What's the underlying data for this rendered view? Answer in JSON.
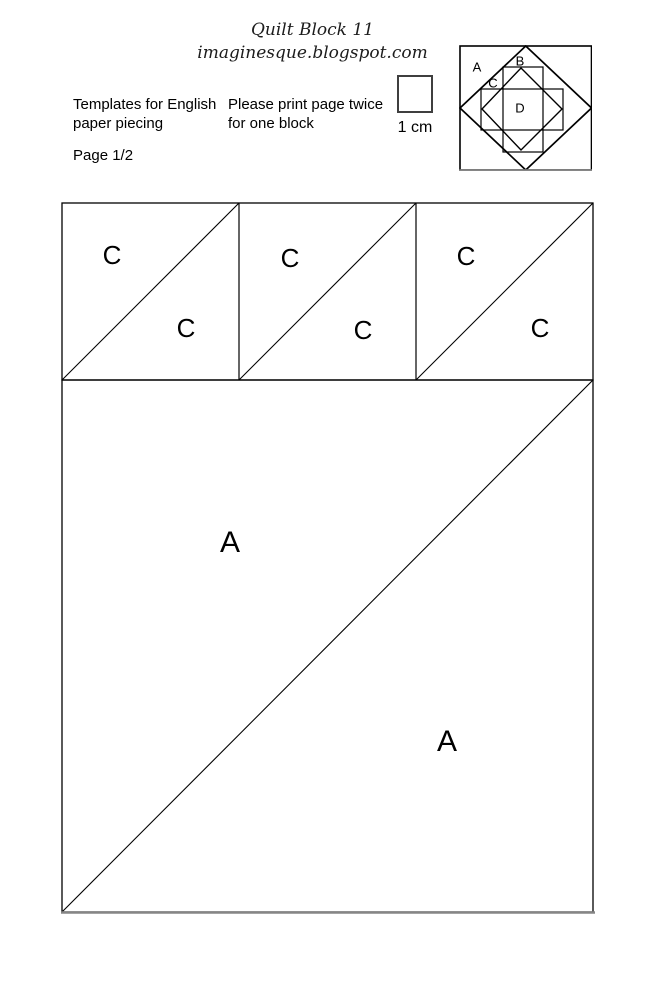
{
  "header": {
    "title": "Quilt Block 11",
    "subtitle": "imaginesque.blogspot.com",
    "left_note": [
      "Templates for English",
      "paper piecing"
    ],
    "print_note": [
      "Please print page twice",
      "for one block"
    ],
    "page_label": "Page 1/2",
    "scale_label": "1 cm"
  },
  "block_diagram": {
    "piece_a": "A",
    "piece_b": "B",
    "piece_c": "C",
    "piece_d": "D"
  },
  "templates": {
    "c_squares": [
      {
        "upper": "C",
        "lower": "C"
      },
      {
        "upper": "C",
        "lower": "C"
      },
      {
        "upper": "C",
        "lower": "C"
      }
    ],
    "a_square": {
      "upper": "A",
      "lower": "A"
    }
  },
  "colors": {
    "line": "#000000",
    "muted_line": "#868686",
    "text": "#000000"
  }
}
